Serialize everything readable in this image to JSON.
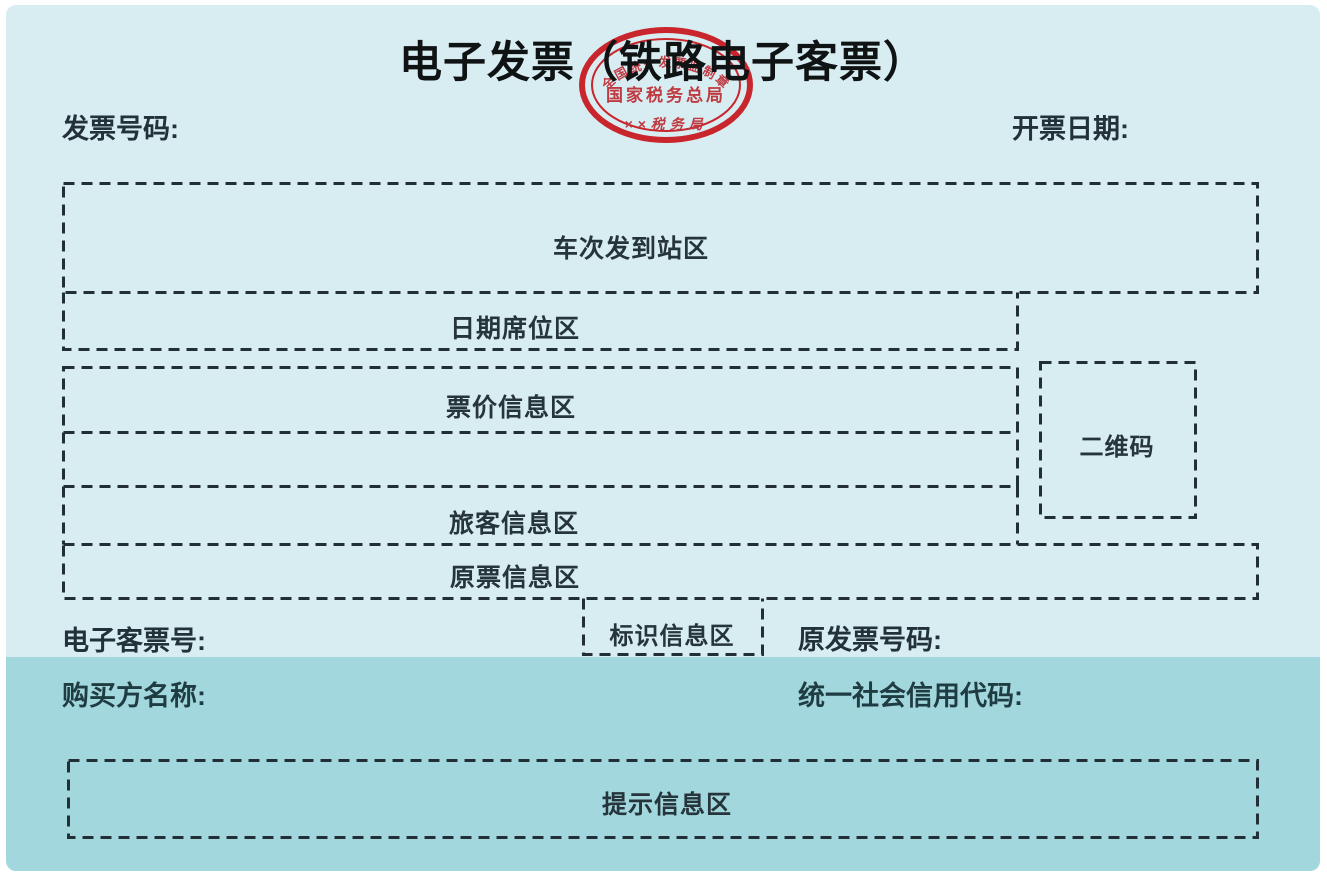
{
  "header": {
    "title": "电子发票（铁路电子客票）",
    "invoice_number_label": "发票号码:",
    "issue_date_label": "开票日期:"
  },
  "seal": {
    "arc_text": "全国统一发票监制章",
    "line1": "国家税务总局",
    "line2": "××税务局"
  },
  "zones": {
    "train_route": "车次发到站区",
    "date_seat": "日期席位区",
    "fare_info": "票价信息区",
    "passenger_info": "旅客信息区",
    "original_ticket_info": "原票信息区",
    "qr_code": "二维码",
    "identification_info": "标识信息区",
    "notice_info": "提示信息区"
  },
  "middle_row": {
    "eticket_number_label": "电子客票号:",
    "original_invoice_number_label": "原发票号码:"
  },
  "buyer_section": {
    "buyer_name_label": "购买方名称:",
    "credit_code_label": "统一社会信用代码:"
  },
  "colors": {
    "panel_bg": "#d8edf2",
    "band_bg": "#a2d8dd",
    "dash": "#232f36",
    "seal_red": "#c9252c",
    "seal_text_red": "#bf3a41",
    "text": "#22313a"
  }
}
